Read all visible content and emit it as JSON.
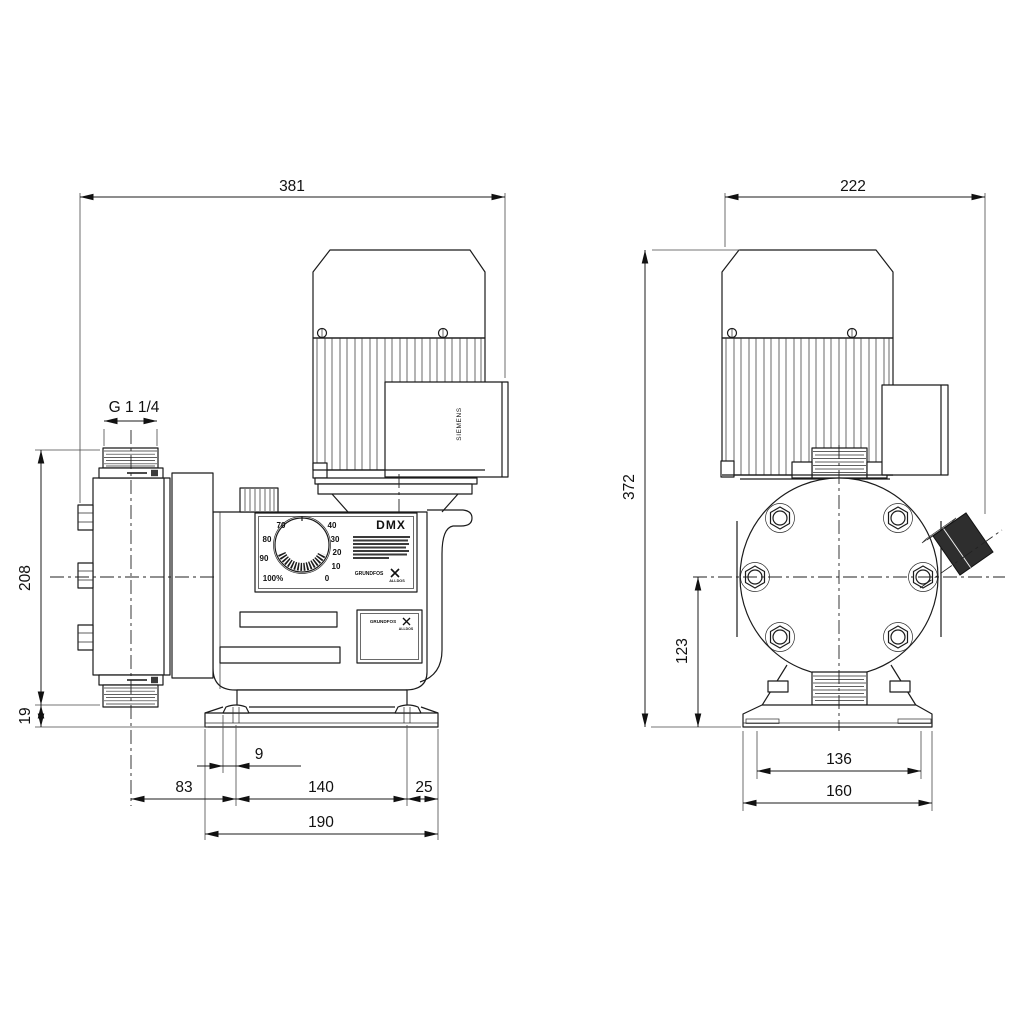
{
  "labels": {
    "model": "DMX",
    "motor_brand": "SIEMENS",
    "logo": "GRUNDFOS",
    "logo_sub": "ALLDOS"
  },
  "knob_scale": [
    "70",
    "80",
    "90",
    "100%",
    "0",
    "10",
    "20",
    "30",
    "40"
  ],
  "dimensions": {
    "side": {
      "overall_width": "381",
      "connection_thread": "G 1 1/4",
      "head_height": "208",
      "base_height": "19",
      "slot_offset": "9",
      "head_to_bolt": "83",
      "bolt_spacing": "140",
      "bolt_to_edge": "25",
      "base_width": "190"
    },
    "front": {
      "overall_width": "222",
      "overall_height": "372",
      "centerline_height": "123",
      "slot_spacing": "136",
      "base_width": "160"
    }
  }
}
